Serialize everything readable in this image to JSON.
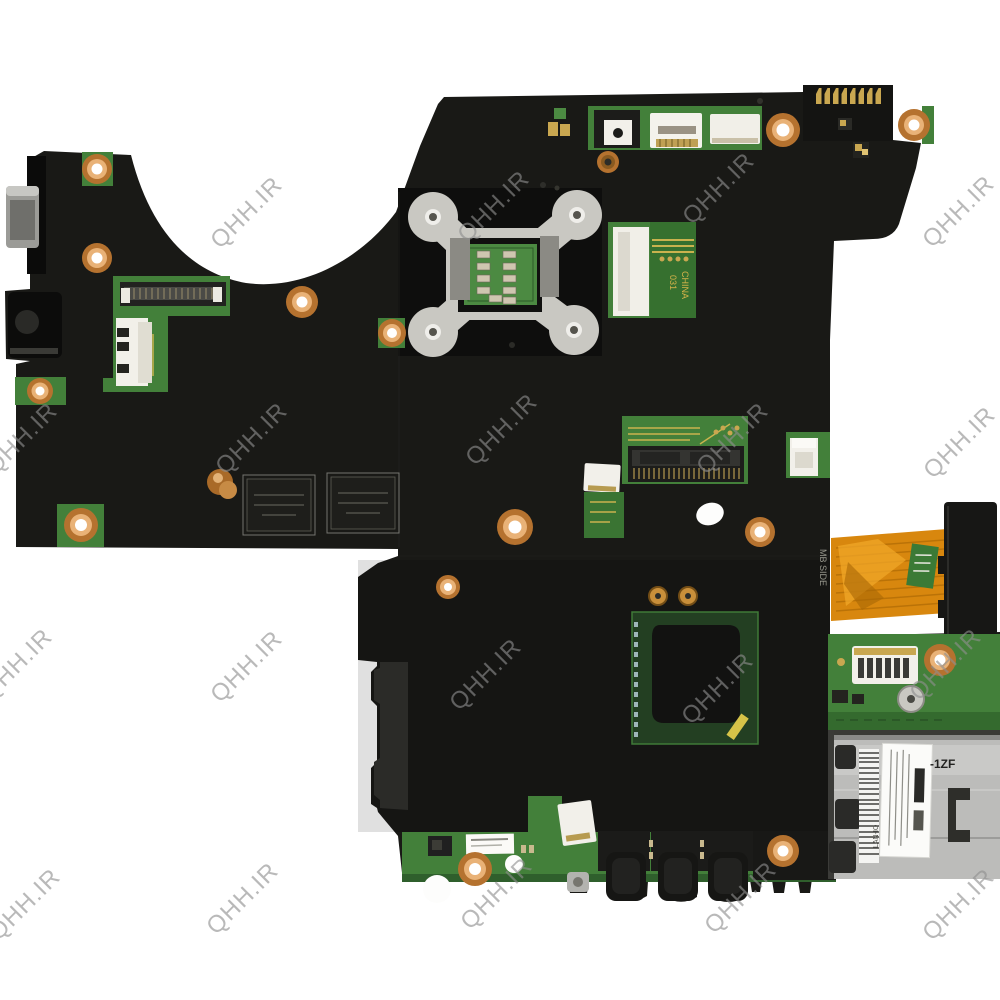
{
  "watermark": {
    "text": "QHH.IR",
    "color": "#8f8f8f",
    "positions": [
      {
        "x": 250,
        "y": 214
      },
      {
        "x": 497,
        "y": 208
      },
      {
        "x": 722,
        "y": 190
      },
      {
        "x": 962,
        "y": 213
      },
      {
        "x": 25,
        "y": 440
      },
      {
        "x": 255,
        "y": 440
      },
      {
        "x": 505,
        "y": 431
      },
      {
        "x": 736,
        "y": 440
      },
      {
        "x": 963,
        "y": 444
      },
      {
        "x": 20,
        "y": 666
      },
      {
        "x": 250,
        "y": 668
      },
      {
        "x": 489,
        "y": 676
      },
      {
        "x": 721,
        "y": 690
      },
      {
        "x": 949,
        "y": 666
      },
      {
        "x": 28,
        "y": 906
      },
      {
        "x": 246,
        "y": 900
      },
      {
        "x": 500,
        "y": 895
      },
      {
        "x": 744,
        "y": 899
      },
      {
        "x": 962,
        "y": 906
      }
    ]
  },
  "labels": {
    "mb_side": "MB SIDE",
    "pcb_marking_number": "031",
    "pcb_marking_country": "CHINA",
    "card_reader_marking": "-1ZF",
    "card_reader_side_marking": "LAN-IO"
  },
  "colors": {
    "board_black": "#191916",
    "pcb_green": "#43803a",
    "pcb_green_dark": "#346a2e",
    "copper": "#b5722f",
    "copper_light": "#e9b277",
    "silver": "#c9c8c2",
    "flex_orange": "#d8870e",
    "metal_gray": "#bcbcba",
    "gold": "#c9a750",
    "die_black": "#121211",
    "watermark_gray": "#8f8f8f",
    "background": "#ffffff"
  }
}
